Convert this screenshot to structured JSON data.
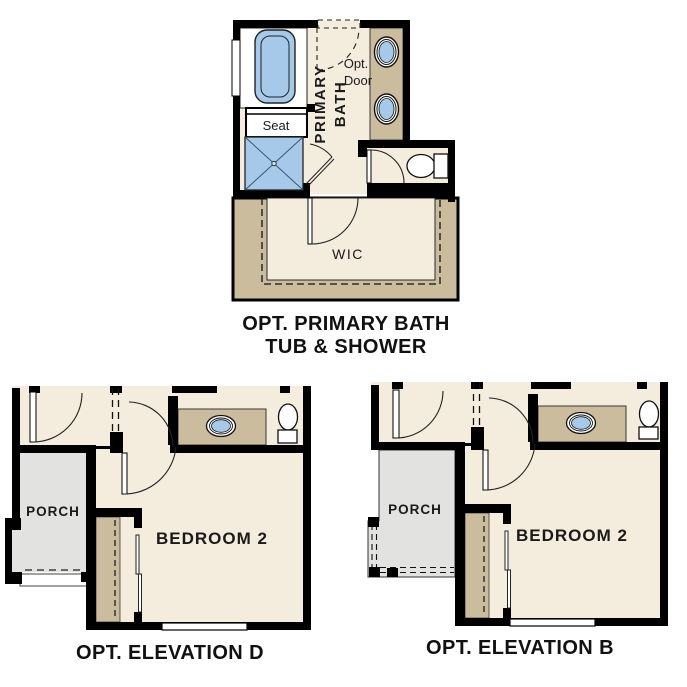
{
  "page": {
    "background": "#ffffff"
  },
  "colors": {
    "wall": "#000000",
    "floor_cream": "#f4ecdc",
    "cabinet_tan": "#cbbc9e",
    "fixture_blue": "#a6c9ea",
    "porch_gray": "#e2e2e0",
    "text": "#111111"
  },
  "plans": {
    "primary_bath": {
      "caption_line1": "OPT. PRIMARY BATH",
      "caption_line2": "TUB & SHOWER",
      "labels": {
        "seat": "Seat",
        "room_line1": "PRIMARY",
        "room_line2": "BATH",
        "opt_door_line1": "Opt.",
        "opt_door_line2": "Door",
        "closet": "WIC"
      }
    },
    "elevation_d": {
      "caption": "OPT. ELEVATION D",
      "labels": {
        "porch": "PORCH",
        "bedroom": "BEDROOM 2"
      }
    },
    "elevation_b": {
      "caption": "OPT. ELEVATION B",
      "labels": {
        "porch": "PORCH",
        "bedroom": "BEDROOM 2"
      }
    }
  }
}
